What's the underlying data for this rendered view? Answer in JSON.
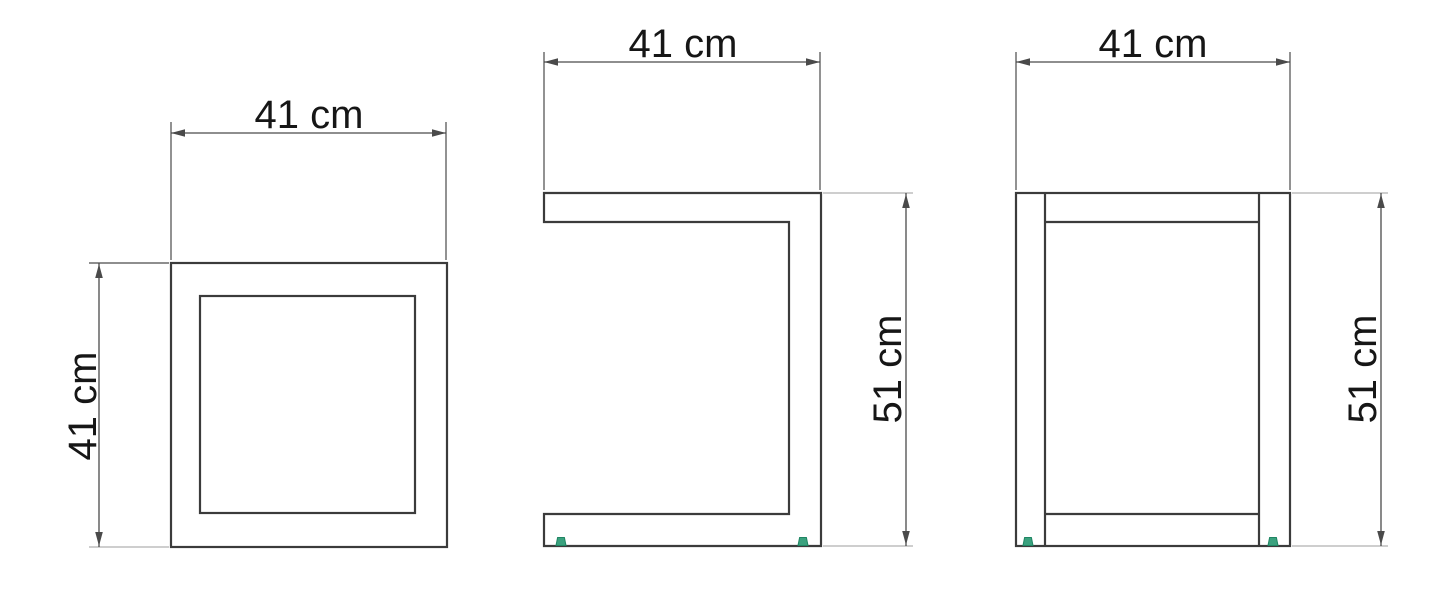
{
  "labels": {
    "top_view_width": "41 cm",
    "top_view_depth": "41 cm",
    "side_view_width": "41 cm",
    "side_view_height": "51 cm",
    "front_view_width": "41 cm",
    "front_view_height": "51 cm"
  },
  "dimensions_cm": {
    "width": 41,
    "depth": 41,
    "height": 51,
    "unit": "cm"
  },
  "colors": {
    "object_line": "#3b3b3b",
    "dimension_line": "#4a4a4a",
    "extension_line": "#9c9c9c",
    "text": "#161616",
    "foot_accent": "#3aa17e",
    "foot_accent_dark": "#1f8563",
    "background": "#ffffff"
  }
}
